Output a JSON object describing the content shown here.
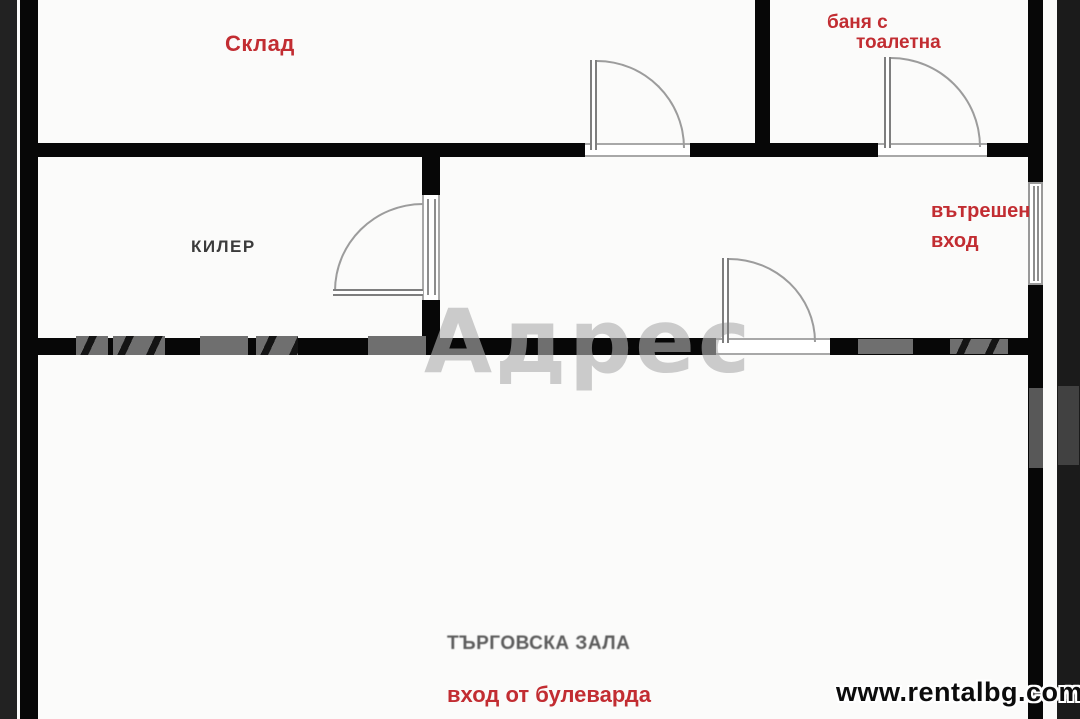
{
  "plan": {
    "rooms": {
      "sklad": "Склад",
      "banya_line1": "баня с",
      "banya_line2": "тоалетна",
      "kiler": "КИЛЕР",
      "hall": "ТЪРГОВСКА ЗАЛА"
    },
    "annotations": {
      "entrance_line1": "вътрешен",
      "entrance_line2": "вход",
      "hall_entrance": "вход от булеварда"
    },
    "watermark": "Адрес",
    "site": "www.rentalbg.com",
    "colors": {
      "label_red": "#c22d32",
      "wall_black": "#070707",
      "photo_border": "#1e1e1e",
      "hall_label_gray": "#5c5c5c",
      "kiler_label_dark": "#3b3b3b"
    }
  }
}
